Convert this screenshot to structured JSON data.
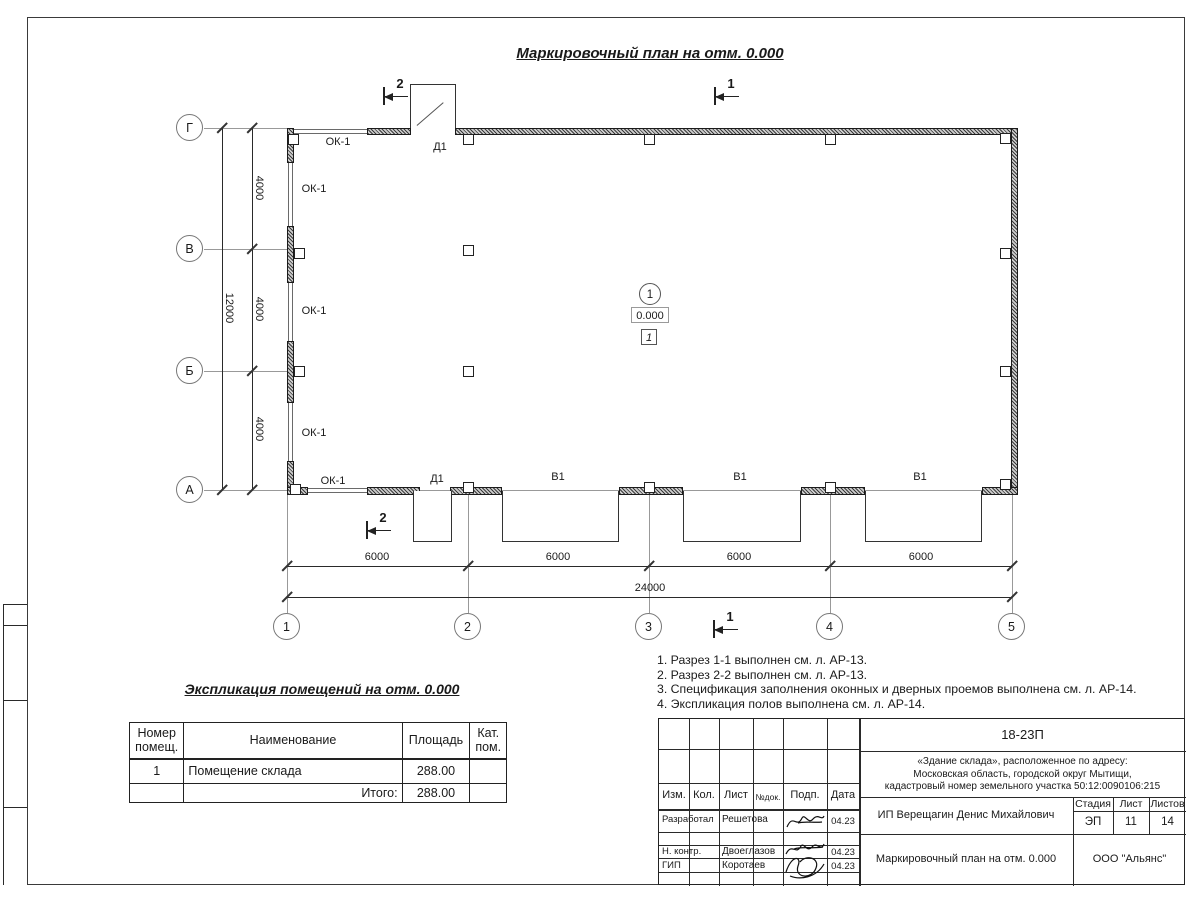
{
  "sheet": {
    "plan_title": "Маркировочный план на отм. 0.000"
  },
  "plan": {
    "row_axes": [
      "Г",
      "В",
      "Б",
      "А"
    ],
    "col_axes": [
      "1",
      "2",
      "3",
      "4",
      "5"
    ],
    "dim_v_seg": "4000",
    "dim_v_total": "12000",
    "dim_h_seg": "6000",
    "dim_h_total": "24000",
    "window_label": "ОК-1",
    "door_label": "Д1",
    "gate_label": "В1",
    "section_1": "1",
    "section_2": "2",
    "room_number": "1",
    "elevation": "0.000",
    "floor_mark": "1"
  },
  "schedule": {
    "title": "Экспликация помещений на отм. 0.000",
    "col_number": "Номер помещ.",
    "col_name": "Наименование",
    "col_area": "Площадь",
    "col_cat": "Кат. пом.",
    "row_number": "1",
    "row_name": "Помещение склада",
    "row_area": "288.00",
    "total_label": "Итого:",
    "total_area": "288.00"
  },
  "notes": {
    "n1": "1. Разрез 1-1 выполнен см. л. АР-13.",
    "n2": "2. Разрез 2-2 выполнен см. л. АР-13.",
    "n3": "3. Спецификация заполнения оконных и дверных проемов выполнена см. л. АР-14.",
    "n4": "4. Экспликация полов выполнена см. л. АР-14."
  },
  "stamp": {
    "code": "18-23П",
    "object_line1": "«Здание склада», расположенное по адресу:",
    "object_line2": "Московская область, городской округ Мытищи,",
    "object_line3": "кадастровый номер земельного участка 50:12:0090106:215",
    "col_izm": "Изм.",
    "col_kol": "Кол.",
    "col_list": "Лист",
    "col_doc": "№док.",
    "col_podp": "Подп.",
    "col_data": "Дата",
    "r1_role": "Разработал",
    "r1_name": "Решетова",
    "r1_date": "04.23",
    "r2_role": "Н. контр.",
    "r2_name": "Двоеглазов",
    "r2_date": "04.23",
    "r3_role": "ГИП",
    "r3_name": "Коротаев",
    "r3_date": "04.23",
    "client": "ИП Верещагин Денис Михайлович",
    "stage_label": "Стадия",
    "sheet_label": "Лист",
    "sheets_label": "Листов",
    "stage": "ЭП",
    "sheet_no": "11",
    "sheets_total": "14",
    "drawing_name": "Маркировочный план на отм. 0.000",
    "company": "ООО \"Альянс\""
  }
}
